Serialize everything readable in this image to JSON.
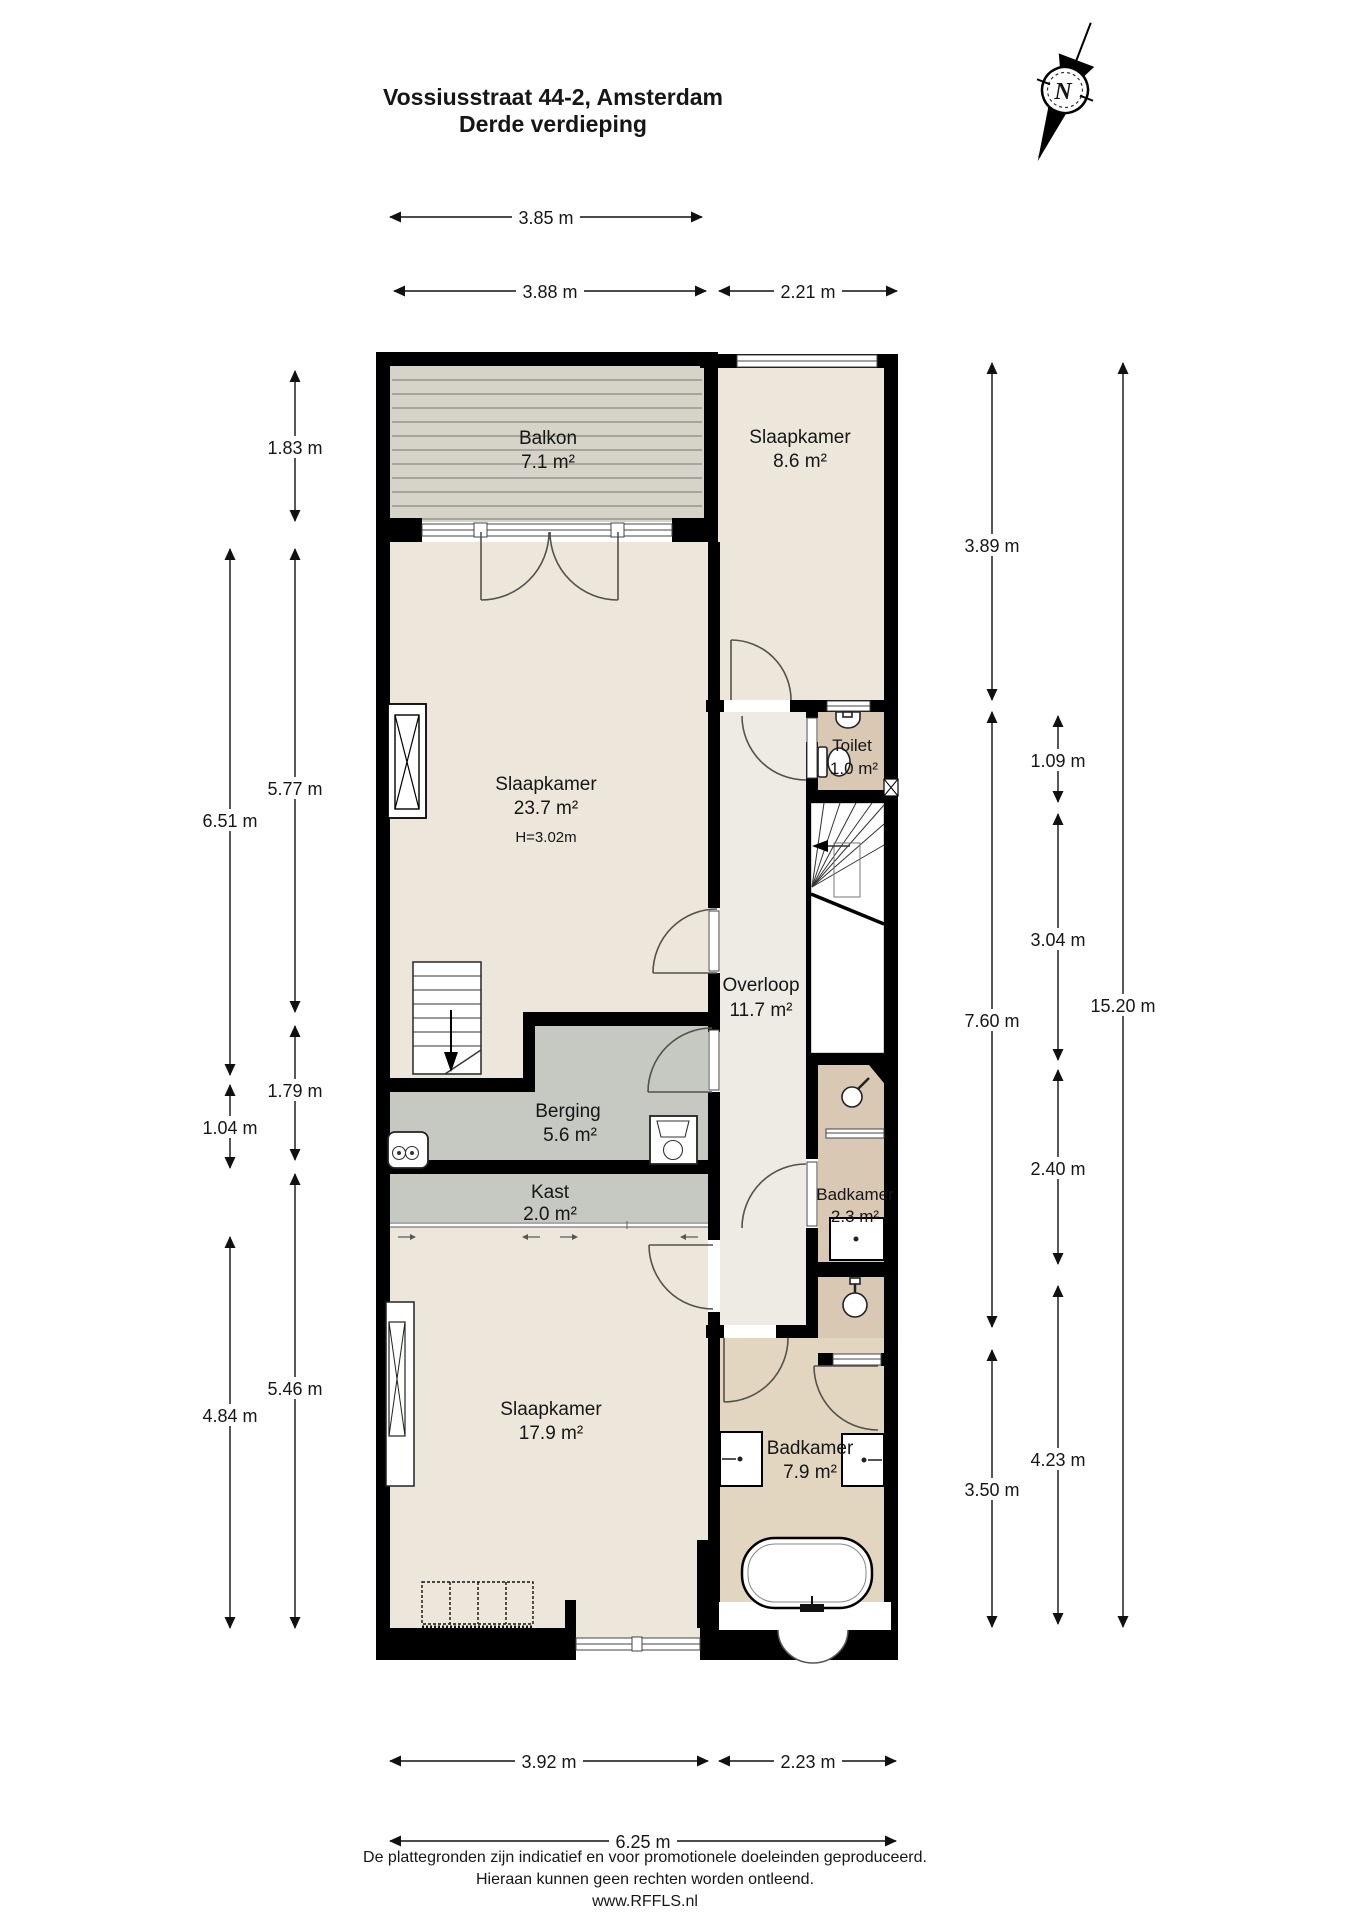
{
  "title": {
    "line1": "Vossiusstraat 44-2, Amsterdam",
    "line2": "Derde verdieping"
  },
  "compass": {
    "north_label": "N"
  },
  "rooms": {
    "balkon": {
      "name": "Balkon",
      "area": "7.1 m²"
    },
    "slaapkamer_ro": {
      "name": "Slaapkamer",
      "area": "8.6 m²"
    },
    "slaapkamer_gr": {
      "name": "Slaapkamer",
      "area": "23.7 m²",
      "hoogte": "H=3.02m"
    },
    "toilet": {
      "name": "Toilet",
      "area": "1.0 m²"
    },
    "overloop": {
      "name": "Overloop",
      "area": "11.7 m²"
    },
    "berging": {
      "name": "Berging",
      "area": "5.6 m²"
    },
    "kast": {
      "name": "Kast",
      "area": "2.0 m²"
    },
    "badkamer_kl": {
      "name": "Badkamer",
      "area": "2.3 m²"
    },
    "slaapkamer_on": {
      "name": "Slaapkamer",
      "area": "17.9 m²"
    },
    "badkamer_gr": {
      "name": "Badkamer",
      "area": "7.9 m²"
    }
  },
  "dimensions": {
    "top": {
      "d1": "3.85 m",
      "d2": "3.88 m",
      "d3": "2.21 m"
    },
    "left": {
      "d1": "1.83 m",
      "d2": "5.77 m",
      "d3": "1.79 m",
      "d4": "5.46 m",
      "d5": "6.51 m",
      "d6": "1.04 m",
      "d7": "4.84 m"
    },
    "right": {
      "d1": "3.89 m",
      "d2": "7.60 m",
      "d3": "3.50 m",
      "d4": "1.09 m",
      "d5": "3.04 m",
      "d6": "2.40 m",
      "d7": "4.23 m",
      "d8": "15.20 m"
    },
    "bottom": {
      "d1": "3.92 m",
      "d2": "2.23 m",
      "d3": "6.25 m"
    }
  },
  "footer": {
    "line1": "De plattegronden zijn indicatief en voor promotionele doeleinden geproduceerd.",
    "line2": "Hieraan kunnen geen rechten worden ontleend.",
    "line3": "www.RFFLS.nl"
  },
  "colors": {
    "wall": "#000000",
    "room_cream": "#ece7da",
    "hall": "#edebe3",
    "stairwell": "#ffffff",
    "storage_gray": "#c6c9c2",
    "bath_tan": "#d9c8b3",
    "bath_tan_light": "#e3d6c1",
    "balcony": "#d6d3c9",
    "balcony_stripe": "#97948c"
  }
}
